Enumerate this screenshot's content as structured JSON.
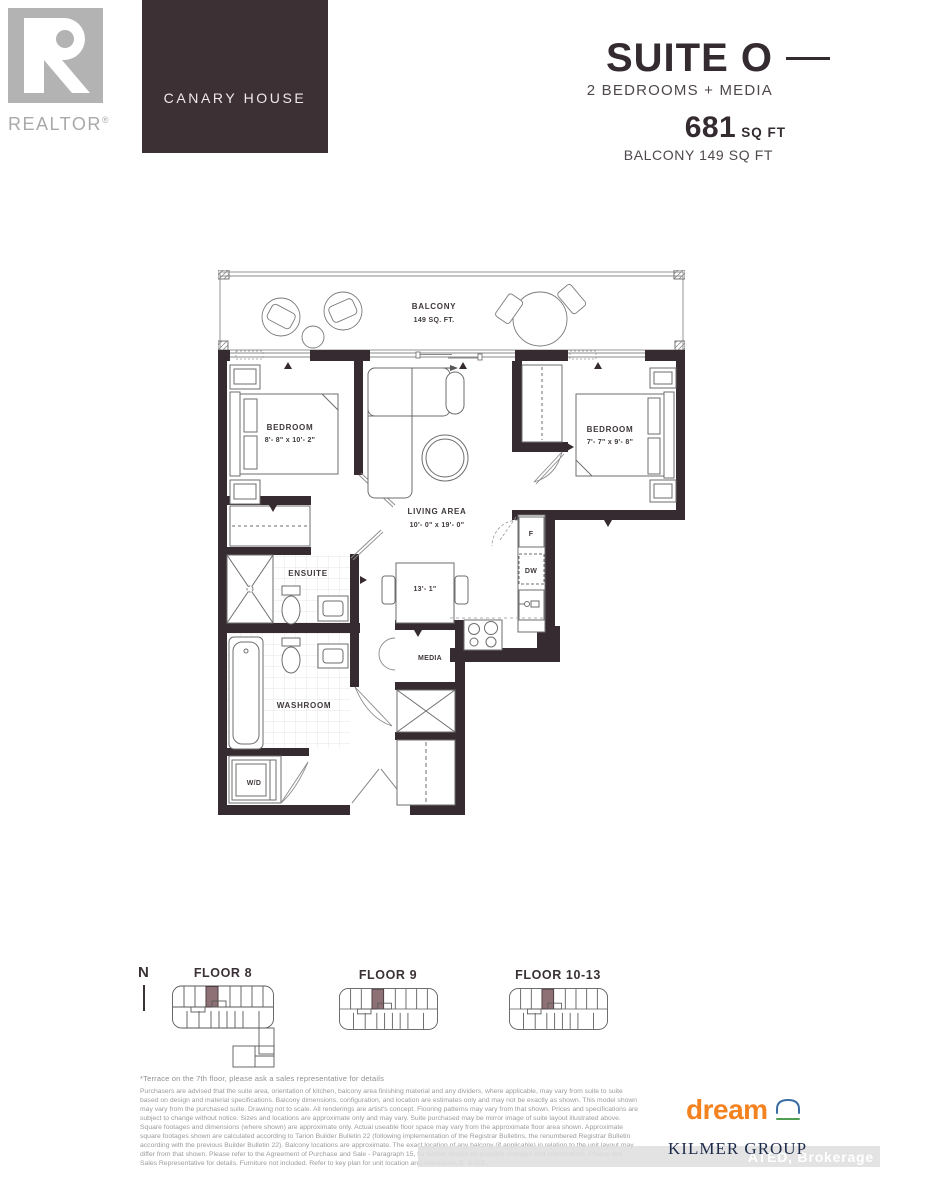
{
  "colors": {
    "brand_box": "#3d3034",
    "plan_wall": "#362b30",
    "keyplan_highlight": "#8d7174",
    "dream_orange": "#f58220",
    "kilmer_navy": "#1c2b4a",
    "realtor_gray": "#b3b3b3"
  },
  "logos": {
    "realtor_label": "REALTOR",
    "realtor_reg": "®",
    "building_name": "CANARY HOUSE",
    "dream": "dream",
    "kilmer": "KILMER GROUP"
  },
  "header": {
    "title": "SUITE O",
    "subtitle": "2 BEDROOMS + MEDIA",
    "area_value": "681",
    "area_unit": "SQ FT",
    "balcony_area": "BALCONY 149 SQ FT"
  },
  "plan": {
    "balcony_l1": "BALCONY",
    "balcony_l2": "149 SQ. FT.",
    "bedroom1_name": "BEDROOM",
    "bedroom1_dims": "8'- 8\" x 10'- 2\"",
    "bedroom2_name": "BEDROOM",
    "bedroom2_dims": "7'- 7\" x 9'- 8\"",
    "living_name": "LIVING AREA",
    "living_dims": "10'- 0\" x 19'- 0\"",
    "ensuite": "ENSUITE",
    "washroom": "WASHROOM",
    "media": "MEDIA",
    "wd": "W/D",
    "fridge": "F",
    "dishwasher": "DW",
    "table_dim": "13'- 1\""
  },
  "keyplans": {
    "north": "N",
    "floor8": "FLOOR 8",
    "floor9": "FLOOR 9",
    "floor10_13": "FLOOR 10-13"
  },
  "footer": {
    "terrace_note": "*Terrace on the 7th floor, please ask a sales representative for details",
    "disclaimer": "Purchasers are advised that the suite area, orientation of kitchen, balcony area finishing material and any dividers, where applicable, may vary from suite to suite based on design and material specifications. Balcony dimensions, configuration, and location are estimates only and may not be exactly as shown. This model shown may vary from the purchased suite. Drawing not to scale. All renderings are artist's concept. Flooring patterns may vary from that shown. Prices and specifications are subject to change without notice. Sizes and locations are approximate only and may vary. Suite purchased may be mirror image of suite layout illustrated above. Square footages and dimensions (where shown) are approximate only. Actual useable floor space may vary from the approximate floor area shown. Approximate square footages shown are calculated according to Tarion Builder Bulletin 22 (following implementation of the Registrar Bulletins, the renumbered Registrar Bulletin according with the previous Builder Bulletin 22). Balcony locations are approximate. The exact location of any balcony (if applicable) in relation to the unit layout may differ from that shown. Please refer to the Agreement of Purchase and Sale - Paragraph 15, for further details on possible changes and substitutions. Please see Sales Representative for details. Furniture not included. Refer to key plan for unit location and orientation. E. & O.E.",
    "watermark": "ATED, Brokerage"
  }
}
